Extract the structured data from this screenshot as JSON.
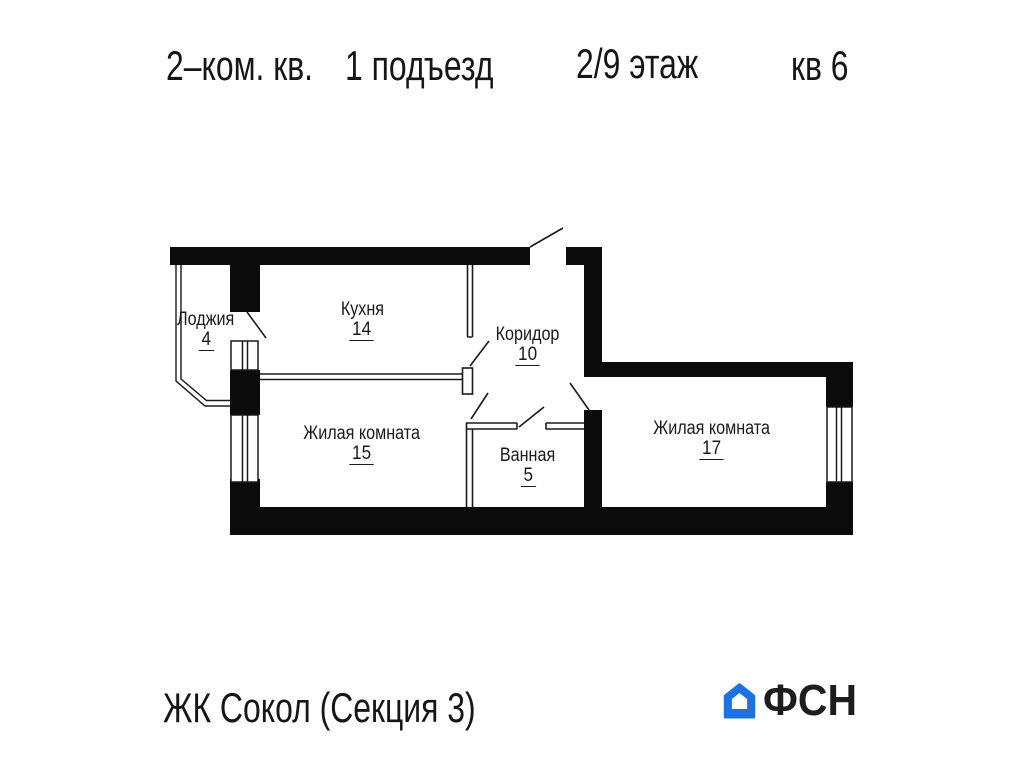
{
  "header": {
    "apartment_type": "2–ком. кв.",
    "entrance": "1 подъезд",
    "floor": "2/9 этаж",
    "apartment_number": "кв 6"
  },
  "plan": {
    "rooms": [
      {
        "id": "loggia",
        "name": "Лоджия",
        "area": "4"
      },
      {
        "id": "kitchen",
        "name": "Кухня",
        "area": "14"
      },
      {
        "id": "corridor",
        "name": "Коридор",
        "area": "10"
      },
      {
        "id": "living-room-1",
        "name": "Жилая комната",
        "area": "15"
      },
      {
        "id": "bathroom",
        "name": "Ванная",
        "area": "5"
      },
      {
        "id": "living-room-2",
        "name": "Жилая комната",
        "area": "17"
      }
    ],
    "wall_color": "#0b0b0b",
    "line_color": "#1a1a1a"
  },
  "footer": {
    "complex_name": "ЖК Сокол (Секция 3)",
    "brand": "ФСН",
    "brand_color": "#1b72e4"
  }
}
